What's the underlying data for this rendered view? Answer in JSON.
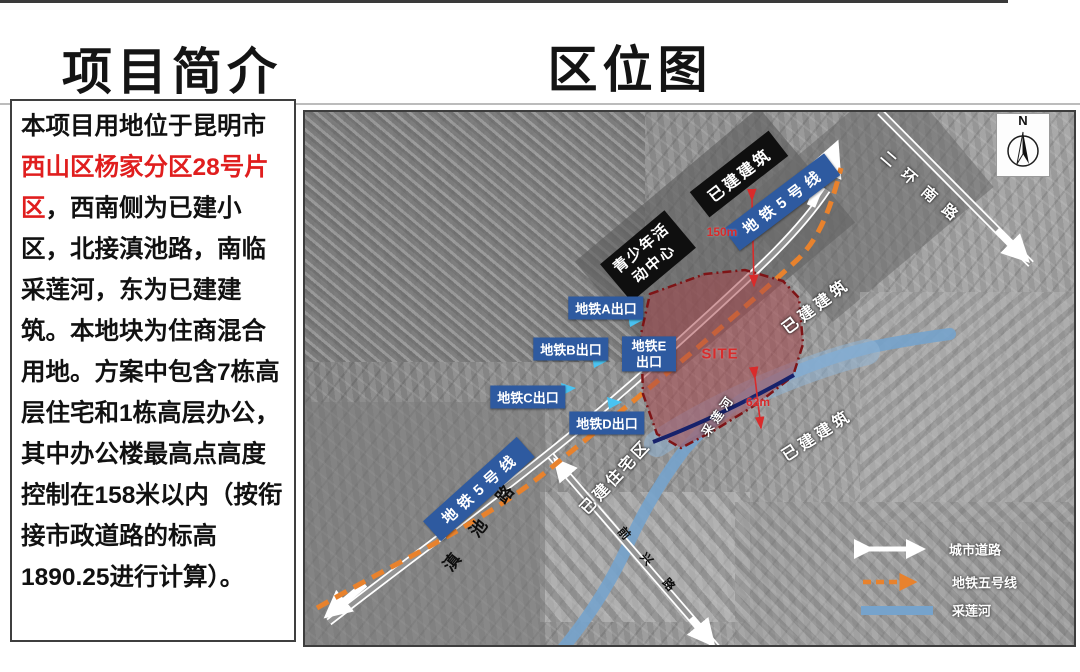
{
  "titles": {
    "left": "项目简介",
    "right": "区位图"
  },
  "intro": {
    "before": "本项目用地位于昆明市",
    "highlight": "西山区杨家分区28号片区",
    "after": "，西南侧为已建小区，北接滇池路，南临采莲河，东为已建建筑。本地块为住商混合用地。方案中包含7栋高层住宅和1栋高层办公，其中办公楼最高点高度控制在158米以内（按衔接市政道路的标高1890.25进行计算）。"
  },
  "map": {
    "north": "N",
    "site": "SITE",
    "dim_metro": "150m",
    "dim_river": "62m",
    "road_labels": {
      "dianchi": "滇池路",
      "erhuan_south": "二环南路",
      "qianxing": "前兴路"
    },
    "metro_line_label_upper": "地铁5号线",
    "metro_line_label_lower": "地铁5号线",
    "area_labels": {
      "built_top": "已建建筑",
      "built_right_top": "已建建筑",
      "built_right_mid": "已建建筑",
      "residential": "已建住宅区",
      "youth_center": "青少年活动中心",
      "river": "采莲河"
    },
    "exits": {
      "a": "地铁A出口",
      "b": "地铁B出口",
      "c": "地铁C出口",
      "d": "地铁D出口",
      "e": "地铁E出口"
    },
    "legend": {
      "items": [
        {
          "symbol": "double-arrow-road",
          "label": "城市道路"
        },
        {
          "symbol": "dashed-arrow-metro",
          "label": "地铁五号线"
        },
        {
          "symbol": "river-line",
          "label": "采莲河"
        }
      ]
    },
    "colors": {
      "metro_orange": "#E8822D",
      "exit_blue": "#2E5AA0",
      "site_border_red": "#7E1416",
      "river_blue": "#76A3CC",
      "highlight_red": "#E01E1E"
    }
  }
}
